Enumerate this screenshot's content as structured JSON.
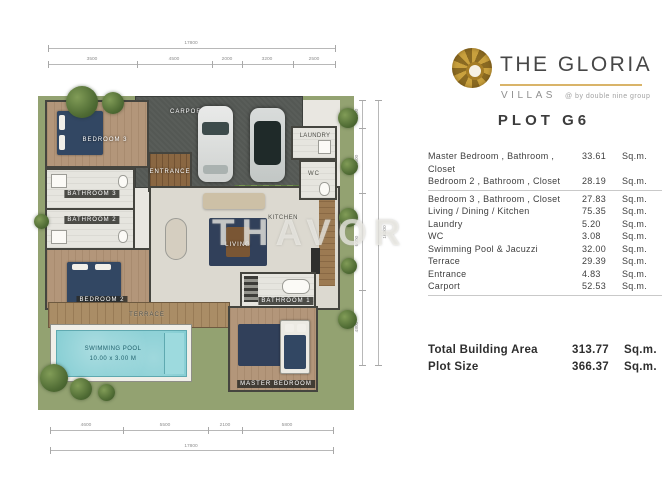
{
  "brand": {
    "title": "THE GLORIA",
    "subtitle": "VILLAS",
    "byline": "@ by double nine group"
  },
  "plot": {
    "title": "PLOT G6"
  },
  "area_table": {
    "unit": "Sq.m.",
    "rows": [
      {
        "name": "Master Bedroom , Bathroom , Closet",
        "value": "33.61"
      },
      {
        "name": "Bedroom 2 , Bathroom , Closet",
        "value": "28.19"
      },
      {
        "name": "Bedroom 3 , Bathroom , Closet",
        "value": "27.83"
      },
      {
        "name": "Living / Dining / Kitchen",
        "value": "75.35"
      },
      {
        "name": "Laundry",
        "value": "5.20"
      },
      {
        "name": "WC",
        "value": "3.08"
      },
      {
        "name": "Swimming Pool & Jacuzzi",
        "value": "32.00"
      },
      {
        "name": "Terrace",
        "value": "29.39"
      },
      {
        "name": "Entrance",
        "value": "4.83"
      },
      {
        "name": "Carport",
        "value": "52.53"
      }
    ],
    "totals": [
      {
        "name": "Total Building Area",
        "value": "313.77"
      },
      {
        "name": "Plot Size",
        "value": "366.37"
      }
    ]
  },
  "floorplan": {
    "watermark": "THAVOR",
    "rooms": {
      "carport": "CARPORT",
      "entrance": "ENTRANCE",
      "laundry": "LAUNDRY",
      "wc": "WC",
      "kitchen": "KITCHEN",
      "living": "LIVING",
      "terrace": "TERRACE",
      "bedroom3": "BEDROOM 3",
      "bathroom3": "BATHROOM 3",
      "bathroom2": "BATHROOM 2",
      "bedroom2": "BEDROOM 2",
      "bathroom1": "BATHROOM 1",
      "master_bedroom": "MASTER BEDROOM",
      "pool_line1": "SWIMMING POOL",
      "pool_line2": "10.00 x 3.00 M"
    },
    "dimensions": {
      "top_total": "17800",
      "top_segments": [
        "3500",
        "4500",
        "2000",
        "3200",
        "2500"
      ],
      "right_segments": [
        "1000",
        "4500",
        "6000",
        "4800"
      ],
      "right_total": "16300",
      "bottom_segments": [
        "4600",
        "5500",
        "2100",
        "5800"
      ],
      "bottom_total": "17800"
    },
    "colors": {
      "grass": "#93a271",
      "carport": "#545854",
      "wood": "#b3967a",
      "pool": "#7fcbd1",
      "bed_navy": "#324763",
      "brand_gold": "#c9a13e"
    }
  }
}
